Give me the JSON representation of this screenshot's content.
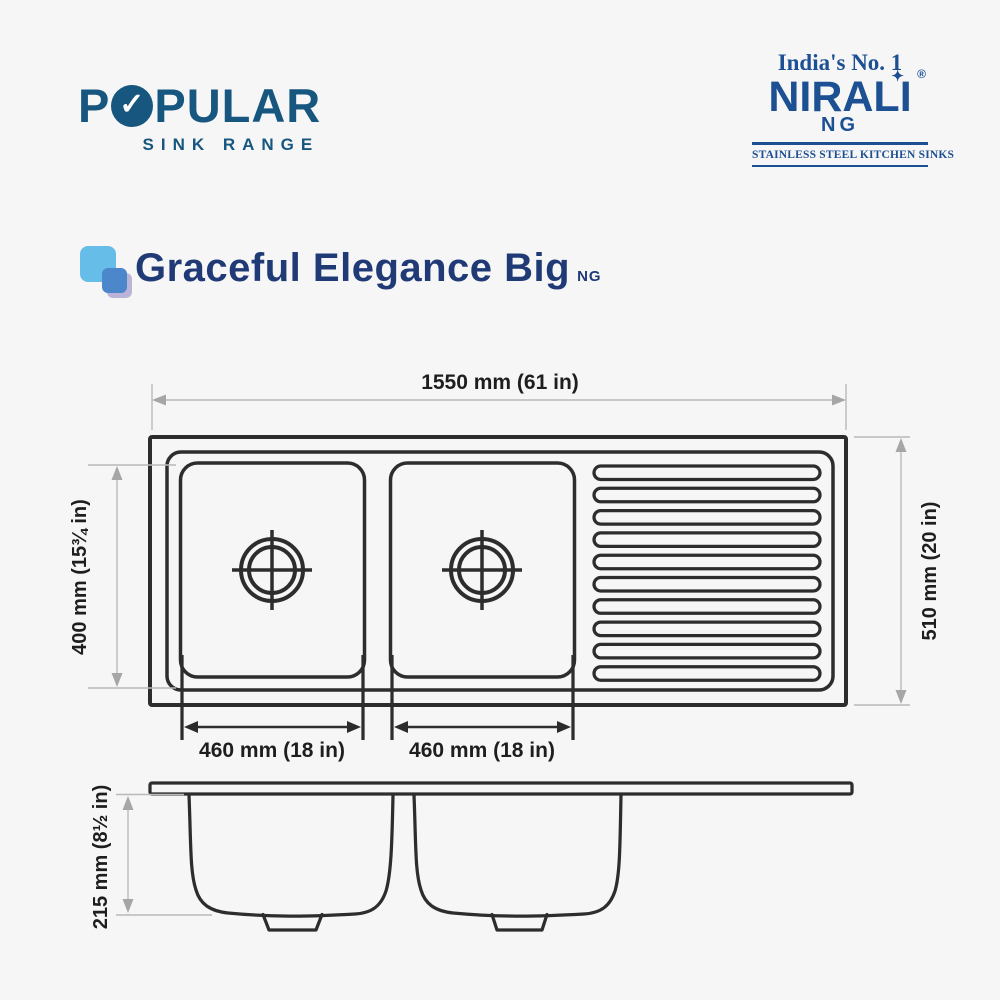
{
  "header": {
    "popular": {
      "name_part1": "P",
      "name_part2": "PULAR",
      "check": "✓",
      "tagline": "SINK RANGE"
    },
    "nirali": {
      "tagline": "India's No. 1",
      "name": "NIRALI",
      "sparkle": "✦",
      "registered": "®",
      "sub": "NG",
      "strip": "STAINLESS STEEL KITCHEN SINKS"
    }
  },
  "product": {
    "title": "Graceful Elegance Big",
    "suffix": "NG"
  },
  "diagram": {
    "dimensions": {
      "overall_width": "1550 mm (61 in)",
      "overall_depth": "510 mm (20 in)",
      "bowl_front": "400 mm (15¾ in)",
      "left_bowl_width": "460 mm (18 in)",
      "right_bowl_width": "460 mm (18 in)",
      "bowl_depth": "215 mm (8½ in)"
    }
  },
  "colors": {
    "brand_blue": "#17567f",
    "nirali_blue": "#1d4f93",
    "title_navy": "#203a76",
    "drawing_line": "#2d2d2d",
    "dimension_gray": "#a6a6a6",
    "label_black": "#1e1e1e",
    "icon_light_blue": "#66bde8",
    "icon_mid_blue": "#4b87ca",
    "icon_lavender": "#a79ccd"
  }
}
